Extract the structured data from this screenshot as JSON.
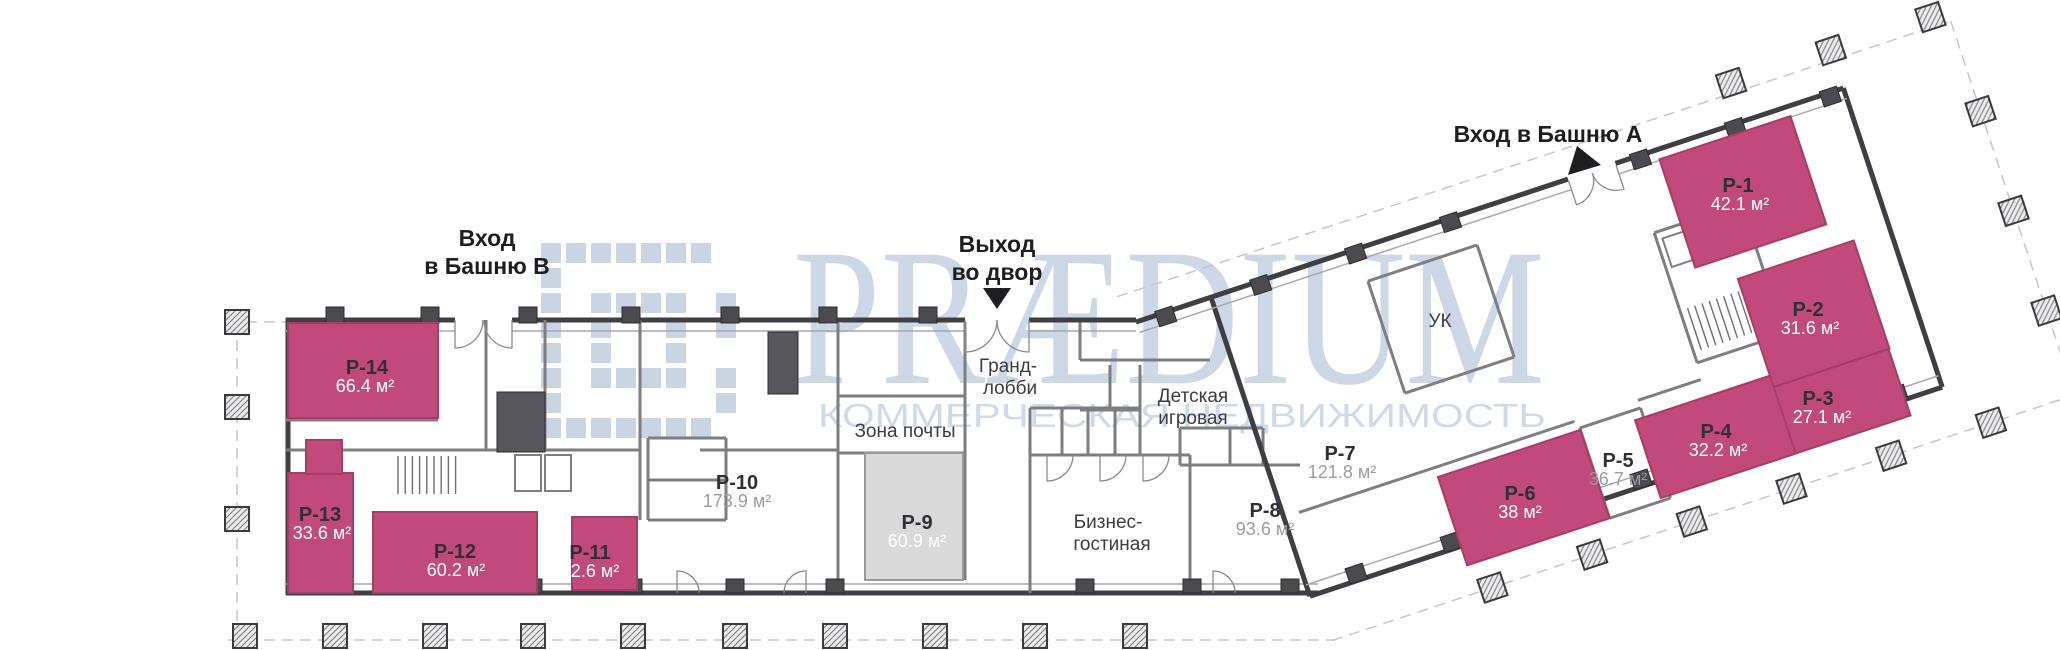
{
  "canvas": {
    "width": 2060,
    "height": 650
  },
  "watermark": {
    "brand": "PRÆDIUM",
    "caption": "КОММЕРЧЕСКАЯ НЕДВИЖИМОСТЬ",
    "color": "#ccd8e6"
  },
  "entrances": [
    {
      "id": "tower-b",
      "lines": [
        "Вход",
        "в Башню В"
      ],
      "arrow": "none"
    },
    {
      "id": "courtyard-exit",
      "lines": [
        "Выход",
        "во двор"
      ],
      "arrow": "down"
    },
    {
      "id": "tower-a",
      "lines": [
        "Вход в Башню А"
      ],
      "arrow": "down-left"
    }
  ],
  "rooms": [
    {
      "id": "grand-lobby",
      "lines": [
        "Гранд-",
        "лобби"
      ]
    },
    {
      "id": "mail-zone",
      "lines": [
        "Зона почты"
      ]
    },
    {
      "id": "kids-playroom",
      "lines": [
        "Детская",
        "игровая"
      ]
    },
    {
      "id": "business-lounge",
      "lines": [
        "Бизнес-",
        "гостиная"
      ]
    },
    {
      "id": "management-company",
      "lines": [
        "УК"
      ]
    }
  ],
  "units": [
    {
      "code": "P-1",
      "area": "42.1 м²",
      "highlight": "pink"
    },
    {
      "code": "P-2",
      "area": "31.6 м²",
      "highlight": "pink"
    },
    {
      "code": "P-3",
      "area": "27.1 м²",
      "highlight": "pink"
    },
    {
      "code": "P-4",
      "area": "32.2 м²",
      "highlight": "pink"
    },
    {
      "code": "P-5",
      "area": "36.7 м²",
      "highlight": "none"
    },
    {
      "code": "P-6",
      "area": "38 м²",
      "highlight": "pink"
    },
    {
      "code": "P-7",
      "area": "121.8 м²",
      "highlight": "none"
    },
    {
      "code": "P-8",
      "area": "93.6 м²",
      "highlight": "none"
    },
    {
      "code": "P-9",
      "area": "60.9 м²",
      "highlight": "gray"
    },
    {
      "code": "P-10",
      "area": "173.9 м²",
      "highlight": "none"
    },
    {
      "code": "P-11",
      "area": "32.6 м²",
      "highlight": "pink"
    },
    {
      "code": "P-12",
      "area": "60.2 м²",
      "highlight": "pink"
    },
    {
      "code": "P-13",
      "area": "33.6 м²",
      "highlight": "pink"
    },
    {
      "code": "P-14",
      "area": "66.4 м²",
      "highlight": "pink"
    }
  ],
  "colors": {
    "unit_highlight": "#c14a7b",
    "unit_highlight_border": "#a63d69",
    "unit_secondary": "#d9d9d9",
    "unit_secondary_border": "#97979c",
    "wall": "#3e3e43",
    "watermark": "#ccd8e6"
  }
}
